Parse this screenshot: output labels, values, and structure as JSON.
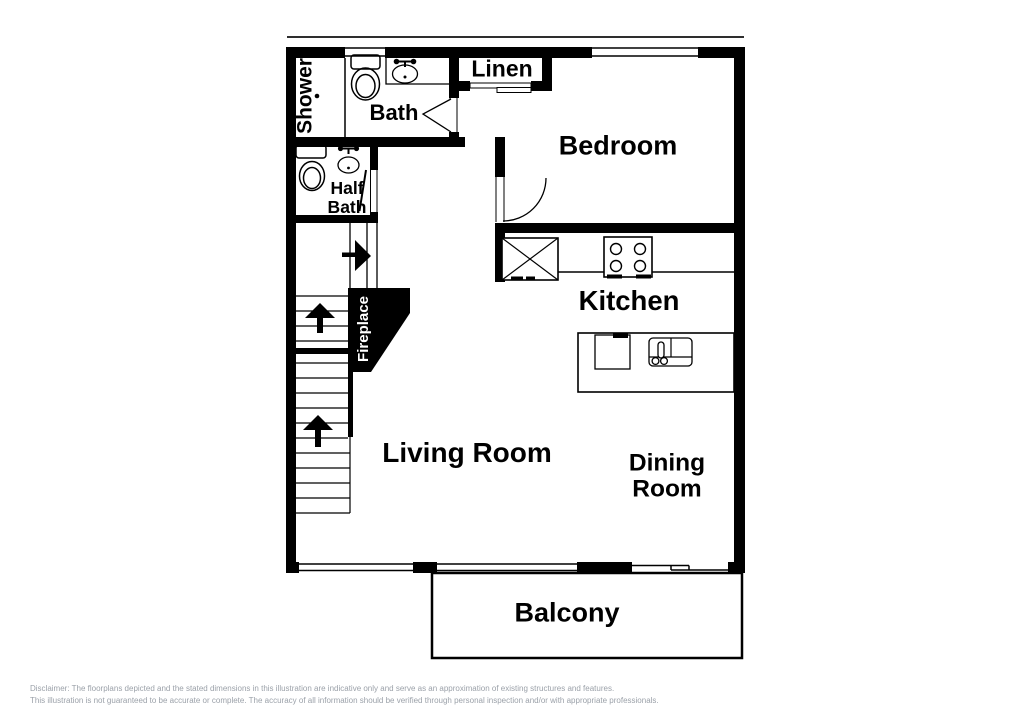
{
  "labels": {
    "shower": "Shower",
    "bath": "Bath",
    "linen": "Linen",
    "half_bath": "Half\nBath",
    "bedroom": "Bedroom",
    "kitchen": "Kitchen",
    "fireplace": "Fireplace",
    "living_room": "Living Room",
    "dining_room": "Dining\nRoom",
    "balcony": "Balcony"
  },
  "disclaimer": {
    "line1": "Disclaimer: The floorplans depicted and the stated dimensions in this illustration are indicative only and serve as an approximation of existing structures and features.",
    "line2": "This illustration is not guaranteed to be accurate or complete. The accuracy of all information should be verified through personal inspection and/or with appropriate professionals."
  },
  "colors": {
    "wall": "#000000",
    "background": "#ffffff",
    "fireplace_fill": "#000000",
    "fireplace_text": "#ffffff",
    "disclaimer_text": "#9ba1a9"
  }
}
